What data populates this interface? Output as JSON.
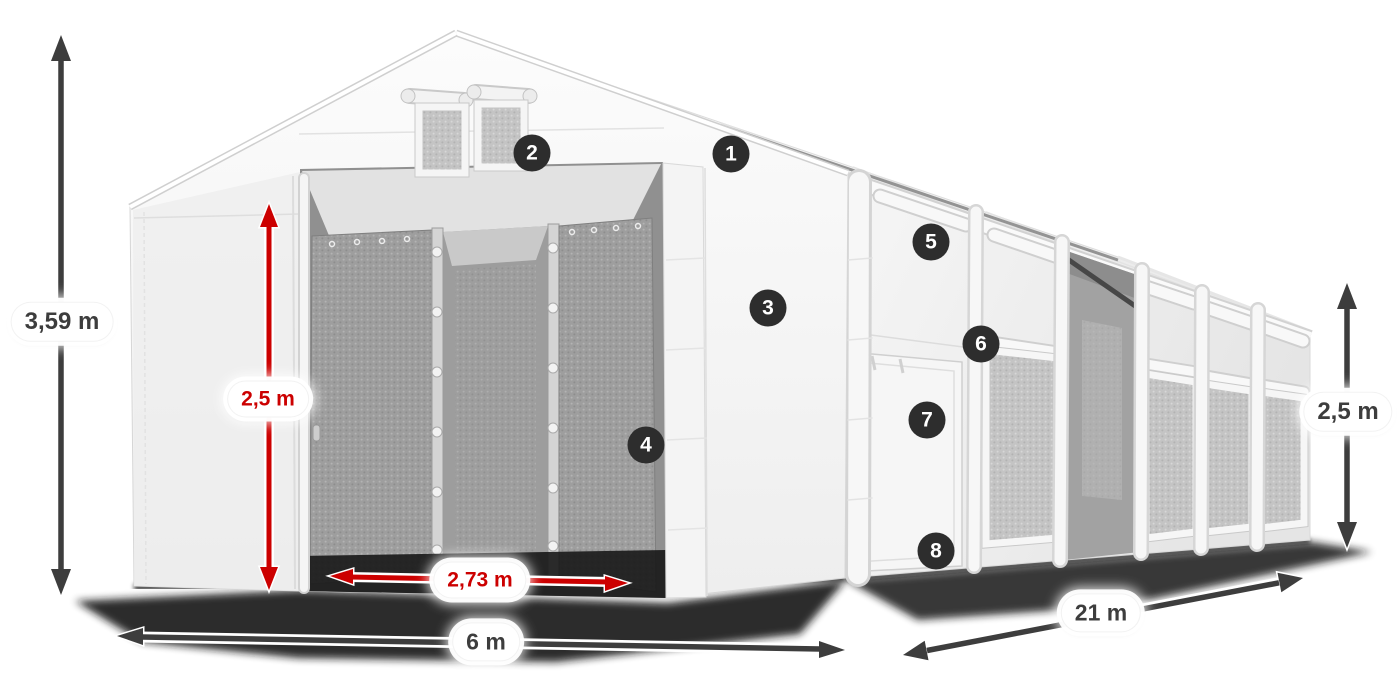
{
  "illustration": {
    "colors": {
      "dimension_dark": "#3d3d3d",
      "dimension_red": "#cc0000",
      "marker_background": "#2d2d2d",
      "marker_text": "#ffffff",
      "label_background": "#ffffff",
      "tent_white": "#f5f5f5",
      "mesh_gray": "#a8a8a8",
      "ground_shadow": "#161616"
    },
    "dimensions": {
      "total_height": {
        "label": "3,59 m",
        "color": "dark"
      },
      "entrance_height": {
        "label": "2,5 m",
        "color": "red"
      },
      "entrance_width": {
        "label": "2,73 m",
        "color": "red"
      },
      "gable_width": {
        "label": "6 m",
        "color": "dark"
      },
      "side_length": {
        "label": "21 m",
        "color": "dark"
      },
      "side_height": {
        "label": "2,5 m",
        "color": "dark"
      }
    },
    "markers": {
      "m1": "1",
      "m2": "2",
      "m3": "3",
      "m4": "4",
      "m5": "5",
      "m6": "6",
      "m7": "7",
      "m8": "8"
    }
  }
}
